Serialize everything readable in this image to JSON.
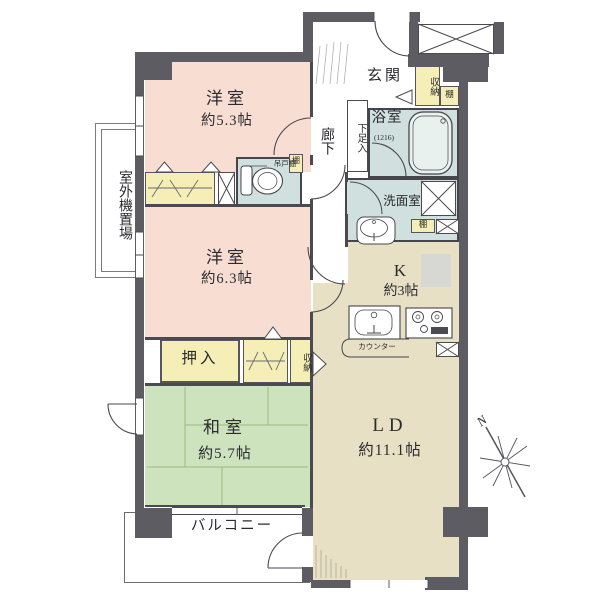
{
  "title": "apartment-floor-plan",
  "colors": {
    "wall": "#5c5c62",
    "western_room": "#f8ddd2",
    "japanese_room": "#cde3bd",
    "living_dining": "#e7e0c4",
    "wet_area": "#cfe0de",
    "storage": "#f5eeb6",
    "line": "#4a4a50"
  },
  "rooms": {
    "western1": {
      "name": "洋室",
      "area": "約5.3帖"
    },
    "western2": {
      "name": "洋室",
      "area": "約6.3帖"
    },
    "japanese": {
      "name": "和室",
      "area": "約5.7帖"
    },
    "living": {
      "name": "LD",
      "area": "約11.1帖"
    },
    "kitchen": {
      "name": "K",
      "area": "約3帖",
      "counter": "カウンター"
    },
    "entrance": {
      "name": "玄関"
    },
    "hallway": {
      "name": "廊下"
    },
    "bathroom": {
      "name": "浴室",
      "size": "(1216)"
    },
    "washroom": {
      "name": "洗面室"
    }
  },
  "storage": {
    "closet_entrance": "収納",
    "shelf_entrance": "棚",
    "shelf_toilet": "棚",
    "shelf_washroom": "棚",
    "hanging_cupboard": "吊戸棚",
    "shoe_cabinet": "下足入",
    "futon_closet": "押入",
    "closet_japanese": "収納"
  },
  "exterior": {
    "balcony": "バルコニー",
    "outdoor_unit_space": "室外機置場",
    "compass_north": "N"
  }
}
